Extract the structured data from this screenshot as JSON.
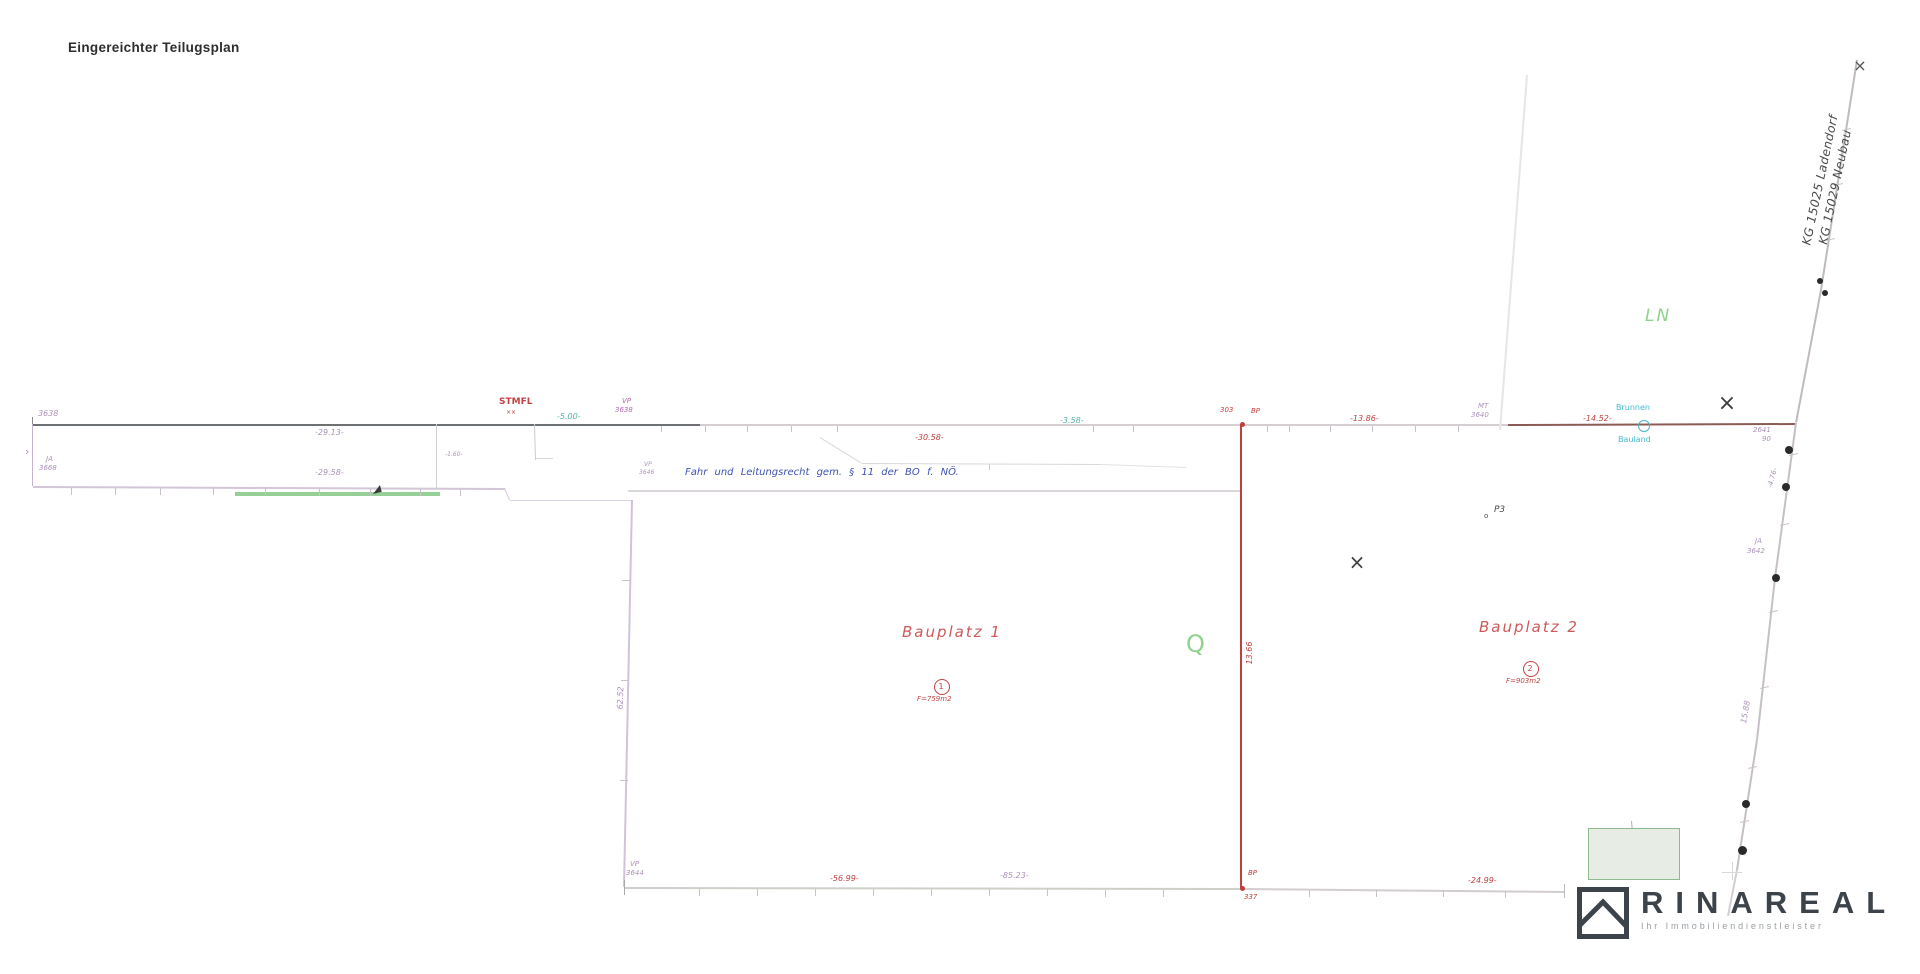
{
  "title": "Eingereichter Teilugsplan",
  "logo": {
    "brand": "RINAREAL",
    "tagline": "Ihr Immobiliendienstleister"
  },
  "colors": {
    "purple": "#ab92b8",
    "red": "#c24242",
    "teal": "#56b2a6",
    "cyan": "#46bacc",
    "blue": "#3f51b0",
    "green": "#8ed28e",
    "dark": "#3e3e3e",
    "line_dark": "#6e7173",
    "line_light": "#d4ced2",
    "line_brown": "#8d5b55",
    "line_purple": "#d0c2d8",
    "line_red": "#c04040",
    "logo_ink": "#3c434a"
  },
  "drawing": {
    "lines": [
      {
        "n": "boundary-top-west",
        "x1": 33,
        "y1": 424,
        "x2": 700,
        "y2": 424,
        "w": 2,
        "c": "#6e7173"
      },
      {
        "n": "boundary-top-mid",
        "x1": 700,
        "y1": 424,
        "x2": 1242,
        "y2": 424,
        "w": 2,
        "c": "#d4ced2"
      },
      {
        "n": "boundary-top-mid2",
        "x1": 1242,
        "y1": 424,
        "x2": 1508,
        "y2": 424,
        "w": 2,
        "c": "#d4ced2"
      },
      {
        "n": "boundary-top-east",
        "x1": 1508,
        "y1": 424,
        "x2": 1796,
        "y2": 423,
        "w": 2,
        "c": "#8d5b55"
      },
      {
        "n": "end-tick",
        "x1": 33,
        "y1": 417,
        "x2": 33,
        "y2": 431,
        "w": 1,
        "c": "#8a8a8a"
      },
      {
        "n": "west-edge-connector",
        "x1": 33,
        "y1": 424,
        "x2": 33,
        "y2": 486,
        "w": 1,
        "c": "#c4b4cc"
      },
      {
        "n": "second-boundary",
        "x1": 33,
        "y1": 486,
        "x2": 505,
        "y2": 488,
        "w": 2,
        "c": "#d2c6d8"
      },
      {
        "n": "green-strip",
        "x1": 235,
        "y1": 492,
        "x2": 440,
        "y2": 492,
        "w": 4,
        "c": "#97d097"
      },
      {
        "n": "jog",
        "x1": 505,
        "y1": 488,
        "x2": 510,
        "y2": 500,
        "w": 1,
        "c": "#d2c6d8"
      },
      {
        "n": "jog",
        "x1": 510,
        "y1": 500,
        "x2": 633,
        "y2": 500,
        "w": 1,
        "c": "#dcd4de"
      },
      {
        "n": "parcel1-west-edge",
        "x1": 633,
        "y1": 500,
        "x2": 625,
        "y2": 887,
        "w": 2,
        "c": "#d0c2d8"
      },
      {
        "n": "easement-south-edge",
        "x1": 628,
        "y1": 490,
        "x2": 1242,
        "y2": 490,
        "w": 2,
        "c": "#dcd7dc"
      },
      {
        "n": "easement-detail",
        "x1": 820,
        "y1": 437,
        "x2": 862,
        "y2": 463,
        "w": 1,
        "c": "#d8d8d8"
      },
      {
        "n": "easement-detail",
        "x1": 862,
        "y1": 463,
        "x2": 1100,
        "y2": 464,
        "w": 1,
        "c": "#d8d8d8"
      },
      {
        "n": "easement-detail",
        "x1": 1100,
        "y1": 464,
        "x2": 1186,
        "y2": 467,
        "w": 1,
        "c": "#e2e2e2"
      },
      {
        "n": "easement-detail",
        "x1": 990,
        "y1": 464,
        "x2": 990,
        "y2": 470,
        "w": 1,
        "c": "#cccccc"
      },
      {
        "n": "division-line",
        "x1": 1242,
        "y1": 424,
        "x2": 1242,
        "y2": 888,
        "w": 2,
        "c": "#c04040"
      },
      {
        "n": "boundary-bottom-west",
        "x1": 625,
        "y1": 887,
        "x2": 1242,
        "y2": 888,
        "w": 2,
        "c": "#ccd0c8"
      },
      {
        "n": "boundary-bottom-east",
        "x1": 1242,
        "y1": 888,
        "x2": 1565,
        "y2": 891,
        "w": 2,
        "c": "#d2cdd0"
      },
      {
        "n": "end-tick",
        "x1": 625,
        "y1": 880,
        "x2": 625,
        "y2": 895,
        "w": 1,
        "c": "#aaaaaa"
      },
      {
        "n": "end-tick",
        "x1": 1565,
        "y1": 884,
        "x2": 1565,
        "y2": 898,
        "w": 1,
        "c": "#bbbbbb"
      },
      {
        "n": "kg-boundary",
        "x1": 1858,
        "y1": 60,
        "x2": 1822,
        "y2": 290,
        "w": 2,
        "c": "#c0bac0"
      },
      {
        "n": "kg-boundary",
        "x1": 1822,
        "y1": 290,
        "x2": 1797,
        "y2": 423,
        "w": 2,
        "c": "#c0bac0"
      },
      {
        "n": "kg-boundary",
        "x1": 1797,
        "y1": 423,
        "x2": 1776,
        "y2": 578,
        "w": 2,
        "c": "#c6bfc6"
      },
      {
        "n": "kg-boundary",
        "x1": 1776,
        "y1": 578,
        "x2": 1758,
        "y2": 740,
        "w": 2,
        "c": "#c6bfc6"
      },
      {
        "n": "kg-boundary",
        "x1": 1758,
        "y1": 740,
        "x2": 1738,
        "y2": 870,
        "w": 2,
        "c": "#c6bfc6"
      },
      {
        "n": "kg-boundary",
        "x1": 1738,
        "y1": 870,
        "x2": 1729,
        "y2": 916,
        "w": 1.5,
        "c": "#d4ced4"
      },
      {
        "n": "old-boundary-faint",
        "x1": 1528,
        "y1": 75,
        "x2": 1501,
        "y2": 430,
        "w": 1.5,
        "c": "#e8e4e8"
      },
      {
        "n": "detail-line",
        "x1": 437,
        "y1": 424,
        "x2": 437,
        "y2": 489,
        "w": 1,
        "c": "#d0d0d0"
      },
      {
        "n": "detail-line",
        "x1": 535,
        "y1": 424,
        "x2": 536,
        "y2": 460,
        "w": 1,
        "c": "#cccccc"
      },
      {
        "n": "detail-line",
        "x1": 536,
        "y1": 458,
        "x2": 553,
        "y2": 458,
        "w": 1,
        "c": "#d8d8d8"
      },
      {
        "n": "detail-line",
        "x1": 1722,
        "y1": 872,
        "x2": 1742,
        "y2": 872,
        "w": 1,
        "c": "#d8d8d8"
      },
      {
        "n": "detail-line",
        "x1": 1733,
        "y1": 862,
        "x2": 1733,
        "y2": 880,
        "w": 1,
        "c": "#d8d8d8"
      },
      {
        "n": "rect-tick",
        "x1": 1632,
        "y1": 821,
        "x2": 1633,
        "y2": 833,
        "w": 1,
        "c": "#b8a8c0"
      }
    ],
    "ticks": [
      [
        662,
        426,
        662,
        432
      ],
      [
        706,
        426,
        706,
        432
      ],
      [
        748,
        426,
        748,
        432
      ],
      [
        792,
        426,
        792,
        432
      ],
      [
        838,
        426,
        838,
        432
      ],
      [
        1094,
        426,
        1094,
        432
      ],
      [
        1134,
        426,
        1134,
        432
      ],
      [
        1268,
        426,
        1268,
        432
      ],
      [
        1290,
        426,
        1290,
        432
      ],
      [
        1331,
        426,
        1331,
        432
      ],
      [
        1373,
        426,
        1373,
        432
      ],
      [
        1416,
        426,
        1416,
        432
      ],
      [
        1459,
        426,
        1459,
        432
      ],
      [
        72,
        488,
        72,
        495
      ],
      [
        116,
        488,
        116,
        495
      ],
      [
        161,
        488,
        161,
        495
      ],
      [
        214,
        488,
        214,
        495
      ],
      [
        266,
        488,
        266,
        495
      ],
      [
        320,
        489,
        320,
        496
      ],
      [
        371,
        489,
        371,
        496
      ],
      [
        421,
        489,
        421,
        496
      ],
      [
        461,
        489,
        461,
        496
      ],
      [
        700,
        889,
        700,
        896
      ],
      [
        758,
        889,
        758,
        896
      ],
      [
        816,
        889,
        816,
        896
      ],
      [
        874,
        889,
        874,
        896
      ],
      [
        932,
        889,
        932,
        896
      ],
      [
        990,
        889,
        990,
        896
      ],
      [
        1048,
        889,
        1048,
        896
      ],
      [
        1106,
        890,
        1106,
        897
      ],
      [
        1164,
        890,
        1164,
        897
      ],
      [
        1310,
        890,
        1310,
        897
      ],
      [
        1377,
        890,
        1377,
        897
      ],
      [
        1444,
        890,
        1444,
        897
      ],
      [
        1506,
        891,
        1506,
        898
      ],
      [
        622,
        580,
        630,
        580
      ],
      [
        621,
        680,
        629,
        680
      ],
      [
        620,
        780,
        628,
        780
      ],
      [
        1789,
        455,
        1798,
        453
      ],
      [
        1780,
        525,
        1789,
        523
      ],
      [
        1769,
        612,
        1778,
        610
      ],
      [
        1760,
        688,
        1769,
        686
      ],
      [
        1748,
        768,
        1757,
        766
      ],
      [
        1740,
        822,
        1749,
        820
      ],
      [
        1842,
        130,
        1851,
        128
      ],
      [
        1834,
        185,
        1843,
        183
      ],
      [
        1826,
        240,
        1835,
        238
      ]
    ],
    "dots": [
      {
        "x": 1820,
        "y": 281,
        "r": 3,
        "c": "#2a2a2a"
      },
      {
        "x": 1825,
        "y": 293,
        "r": 3,
        "c": "#2a2a2a"
      },
      {
        "x": 1789,
        "y": 450,
        "r": 4,
        "c": "#2a2a2a"
      },
      {
        "x": 1786,
        "y": 487,
        "r": 4,
        "c": "#2a2a2a"
      },
      {
        "x": 1776,
        "y": 578,
        "r": 4,
        "c": "#2a2a2a"
      },
      {
        "x": 1746,
        "y": 804,
        "r": 4,
        "c": "#2a2a2a"
      },
      {
        "x": 1742,
        "y": 850,
        "r": 4.5,
        "c": "#2a2a2a"
      },
      {
        "x": 1242,
        "y": 424,
        "r": 2.5,
        "c": "#c04040"
      },
      {
        "x": 1242,
        "y": 888,
        "r": 2.5,
        "c": "#c04040"
      }
    ],
    "circles": [
      {
        "n": "brunnen-symbol",
        "x": 1643,
        "y": 425,
        "r": 5,
        "c": "#49b6c6",
        "w": 1.2
      },
      {
        "n": "parcel-1-number-circle",
        "x": 941,
        "y": 686,
        "r": 7,
        "c": "#c24242",
        "w": 1.2
      },
      {
        "n": "parcel-2-number-circle",
        "x": 1530,
        "y": 668,
        "r": 7,
        "c": "#c24242",
        "w": 1.2
      }
    ],
    "rects": [
      {
        "n": "building-area",
        "x": 1588,
        "y": 828,
        "w": 90,
        "h": 50,
        "f": "#e7ece4",
        "s": "#8fba8f"
      }
    ],
    "tris": [
      {
        "n": "flag-mark",
        "x": 372,
        "y": 486,
        "c": "#3a3a3a",
        "r": -15
      }
    ],
    "labels": [
      {
        "n": "point-label",
        "t": "3638",
        "x": 38,
        "y": 410,
        "c": "#ab92b8",
        "s": 8,
        "i": 1
      },
      {
        "n": "dim-label",
        "t": "-29.13-",
        "x": 315,
        "y": 429,
        "c": "#ab92b8",
        "s": 8,
        "i": 1
      },
      {
        "n": "point-label",
        "t": "STMFL",
        "x": 499,
        "y": 398,
        "c": "#c24242",
        "s": 9,
        "b": 1
      },
      {
        "n": "point-mark",
        "t": "××",
        "x": 506,
        "y": 410,
        "c": "#c24242",
        "s": 6
      },
      {
        "n": "dim-label",
        "t": "-5.00-",
        "x": 557,
        "y": 413,
        "c": "#56b2a6",
        "s": 8,
        "i": 1
      },
      {
        "n": "point-label",
        "t": "VP",
        "x": 622,
        "y": 398,
        "c": "#b36ab3",
        "s": 7,
        "i": 1
      },
      {
        "n": "point-label",
        "t": "3638",
        "x": 615,
        "y": 407,
        "c": "#b36ab3",
        "s": 7,
        "i": 1
      },
      {
        "n": "dim-label",
        "t": "-30.58-",
        "x": 915,
        "y": 434,
        "c": "#c24242",
        "s": 8,
        "i": 1
      },
      {
        "n": "dim-label",
        "t": "-3.58-",
        "x": 1060,
        "y": 417,
        "c": "#56b2a6",
        "s": 8,
        "i": 1
      },
      {
        "n": "point-label",
        "t": "303",
        "x": 1220,
        "y": 407,
        "c": "#c24242",
        "s": 7,
        "i": 1
      },
      {
        "n": "point-label",
        "t": "BP",
        "x": 1251,
        "y": 408,
        "c": "#c24242",
        "s": 7,
        "i": 1
      },
      {
        "n": "dim-label",
        "t": "-13.86-",
        "x": 1350,
        "y": 415,
        "c": "#c24242",
        "s": 8,
        "i": 1
      },
      {
        "n": "point-label",
        "t": "MT",
        "x": 1478,
        "y": 403,
        "c": "#ab92b8",
        "s": 7,
        "i": 1
      },
      {
        "n": "point-label",
        "t": "3640",
        "x": 1471,
        "y": 412,
        "c": "#ab92b8",
        "s": 7,
        "i": 1
      },
      {
        "n": "dim-label",
        "t": "-14.52-",
        "x": 1583,
        "y": 415,
        "c": "#c24242",
        "s": 8,
        "i": 1
      },
      {
        "n": "brunnen-label",
        "t": "Brunnen",
        "x": 1616,
        "y": 404,
        "c": "#46bacc",
        "s": 8
      },
      {
        "n": "bauland-label",
        "t": "Bauland",
        "x": 1618,
        "y": 436,
        "c": "#46bacc",
        "s": 8
      },
      {
        "n": "point-label",
        "t": "2641",
        "x": 1753,
        "y": 427,
        "c": "#ab92b8",
        "s": 7,
        "i": 1
      },
      {
        "n": "point-label",
        "t": "90",
        "x": 1762,
        "y": 436,
        "c": "#ab92b8",
        "s": 7,
        "i": 1
      },
      {
        "n": "dim-label",
        "t": "-4.76-",
        "cx": 1773,
        "cy": 478,
        "c": "#ab92b8",
        "s": 7,
        "r": -75,
        "i": 1
      },
      {
        "n": "point-label",
        "t": "JA",
        "x": 1755,
        "y": 538,
        "c": "#ab92b8",
        "s": 7,
        "i": 1
      },
      {
        "n": "point-label",
        "t": "3642",
        "x": 1747,
        "y": 548,
        "c": "#ab92b8",
        "s": 7,
        "i": 1
      },
      {
        "n": "dim-label",
        "t": "15.88",
        "cx": 1746,
        "cy": 712,
        "c": "#ab92b8",
        "s": 8,
        "r": -80,
        "i": 1
      },
      {
        "n": "ln-label",
        "t": "LN",
        "x": 1645,
        "y": 308,
        "c": "#8ed28e",
        "s": 17,
        "i": 1,
        "ls": 2
      },
      {
        "n": "kg-label-ladendorf",
        "t": "KG 15025 Ladendorf",
        "cx": 1820,
        "cy": 180,
        "c": "#4a4a4a",
        "s": 12,
        "r": -78,
        "i": 1,
        "ls": 0.5
      },
      {
        "n": "kg-label-neubau",
        "t": "KG 15029 Neubau",
        "cx": 1835,
        "cy": 187,
        "c": "#4a4a4a",
        "s": 12,
        "r": -78,
        "i": 1,
        "ls": 0.5
      },
      {
        "n": "point-label",
        "t": "JA",
        "x": 46,
        "y": 456,
        "c": "#ab92b8",
        "s": 7,
        "i": 1
      },
      {
        "n": "point-label",
        "t": "3668",
        "x": 39,
        "y": 465,
        "c": "#ab92b8",
        "s": 7,
        "i": 1
      },
      {
        "n": "arrow-mark",
        "t": "›",
        "x": 25,
        "y": 446,
        "c": "#b08ab8",
        "s": 11
      },
      {
        "n": "dim-label",
        "t": "-29.58-",
        "x": 315,
        "y": 469,
        "c": "#ab92b8",
        "s": 8,
        "i": 1
      },
      {
        "n": "easement-text",
        "t": "Fahr und Leitungsrecht gem. § 11 der BO f. NÖ.",
        "x": 685,
        "y": 468,
        "c": "#3f51b0",
        "s": 10,
        "i": 1,
        "ws": 4
      },
      {
        "n": "point-label",
        "t": "VP",
        "x": 644,
        "y": 462,
        "c": "#ab92b8",
        "s": 6,
        "i": 1
      },
      {
        "n": "point-label",
        "t": "3646",
        "x": 639,
        "y": 470,
        "c": "#ab92b8",
        "s": 6,
        "i": 1
      },
      {
        "n": "dim-label",
        "t": "-1.60-",
        "x": 445,
        "y": 452,
        "c": "#ab92b8",
        "s": 6,
        "i": 1
      },
      {
        "n": "dim-label",
        "t": "62.52",
        "cx": 621,
        "cy": 698,
        "c": "#ab92b8",
        "s": 8,
        "r": -88,
        "i": 1
      },
      {
        "n": "parcel-1-label",
        "t": "Bauplatz  1",
        "x": 902,
        "y": 625,
        "c": "#cd5a5a",
        "s": 15,
        "i": 1,
        "ls": 2
      },
      {
        "n": "parcel-1-number",
        "t": "1",
        "cx": 941,
        "cy": 687,
        "c": "#c24242",
        "s": 8
      },
      {
        "n": "parcel-1-area",
        "t": "F=759m2",
        "x": 917,
        "y": 696,
        "c": "#c24242",
        "s": 7,
        "i": 1
      },
      {
        "n": "q-label",
        "t": "Q",
        "x": 1186,
        "y": 632,
        "c": "#8ed28e",
        "s": 24
      },
      {
        "n": "dim-label",
        "t": "13.66",
        "cx": 1250,
        "cy": 653,
        "c": "#c24242",
        "s": 8,
        "r": -90,
        "i": 1
      },
      {
        "n": "parcel-2-label",
        "t": "Bauplatz  2",
        "x": 1479,
        "y": 620,
        "c": "#cd5a5a",
        "s": 15,
        "i": 1,
        "ls": 2
      },
      {
        "n": "parcel-2-number",
        "t": "2",
        "cx": 1530,
        "cy": 669,
        "c": "#c24242",
        "s": 8
      },
      {
        "n": "parcel-2-area",
        "t": "F=903m2",
        "x": 1506,
        "y": 678,
        "c": "#c24242",
        "s": 7,
        "i": 1
      },
      {
        "n": "point-mark",
        "t": "o",
        "x": 1484,
        "y": 513,
        "c": "#4a4a4a",
        "s": 7
      },
      {
        "n": "point-label",
        "t": "P3",
        "x": 1494,
        "y": 506,
        "c": "#4a4a4a",
        "s": 9,
        "i": 1
      },
      {
        "n": "dim-label",
        "t": "-56.99-",
        "x": 830,
        "y": 875,
        "c": "#c24242",
        "s": 8,
        "i": 1
      },
      {
        "n": "dim-label",
        "t": "-85.23-",
        "x": 1000,
        "y": 872,
        "c": "#ab92b8",
        "s": 8,
        "i": 1
      },
      {
        "n": "point-label",
        "t": "BP",
        "x": 1248,
        "y": 870,
        "c": "#c24242",
        "s": 7,
        "i": 1
      },
      {
        "n": "point-label",
        "t": "337",
        "x": 1244,
        "y": 894,
        "c": "#c24242",
        "s": 7,
        "i": 1
      },
      {
        "n": "dim-label",
        "t": "-24.99-",
        "x": 1468,
        "y": 877,
        "c": "#c24242",
        "s": 8,
        "i": 1
      },
      {
        "n": "point-label",
        "t": "VP",
        "x": 630,
        "y": 861,
        "c": "#ab92b8",
        "s": 7,
        "i": 1
      },
      {
        "n": "point-label",
        "t": "3644",
        "x": 626,
        "y": 870,
        "c": "#ab92b8",
        "s": 7,
        "i": 1
      },
      {
        "n": "cross-mark",
        "t": "×",
        "cx": 1357,
        "cy": 562,
        "c": "#3d3d3d",
        "s": 20
      },
      {
        "n": "cross-mark",
        "t": "×",
        "cx": 1727,
        "cy": 404,
        "c": "#3d3d3d",
        "s": 22
      },
      {
        "n": "cross-mark",
        "t": "×",
        "cx": 1860,
        "cy": 66,
        "c": "#555555",
        "s": 16
      }
    ]
  }
}
